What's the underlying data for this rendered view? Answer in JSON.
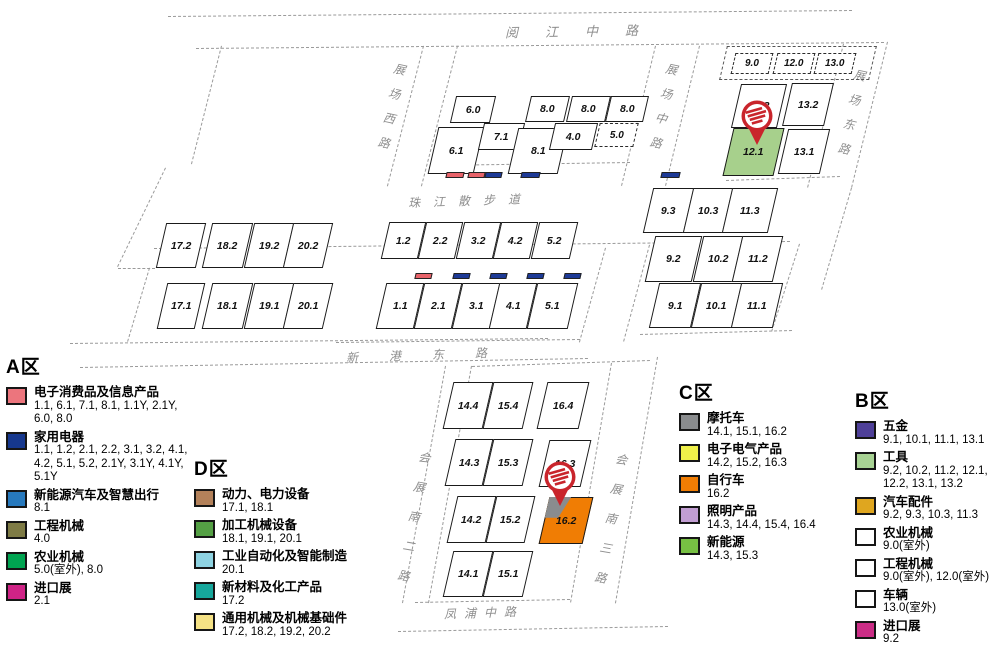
{
  "map": {
    "background": "#ffffff",
    "pin_color": "#c9252c",
    "roads_horizontal": [
      {
        "id": "yuejiang-middle-road",
        "label": "阅江中路",
        "x": 505,
        "y": 21,
        "fs": 13,
        "ls": 27,
        "rot": -1
      },
      {
        "id": "zhujiang-walkway",
        "label": "珠江散步道",
        "x": 408,
        "y": 192,
        "fs": 12,
        "ls": 13,
        "rot": -2
      },
      {
        "id": "xingang-east-road",
        "label": "新港东路",
        "x": 346,
        "y": 346,
        "fs": 12,
        "ls": 31,
        "rot": -2
      },
      {
        "id": "fengpu-middle-road",
        "label": "凤浦中路",
        "x": 444,
        "y": 604,
        "fs": 12,
        "ls": 8,
        "rot": -2
      }
    ],
    "roads_vertical": [
      {
        "id": "zhanchang-west-road",
        "label": "展场西路",
        "x": 396,
        "y": 58,
        "fs": 12,
        "pitch": 25,
        "rot": 12
      },
      {
        "id": "zhanchang-middle-road",
        "label": "展场中路",
        "x": 668,
        "y": 58,
        "fs": 12,
        "pitch": 25,
        "rot": 12
      },
      {
        "id": "zhanchang-east-road",
        "label": "展场东路",
        "x": 856,
        "y": 64,
        "fs": 12,
        "pitch": 25,
        "rot": 12
      },
      {
        "id": "huizhan-south-2nd-road",
        "label": "会展南二路",
        "x": 421,
        "y": 443,
        "fs": 12,
        "pitch": 30,
        "rot": 10
      },
      {
        "id": "huizhan-south-3rd-road",
        "label": "会展南三路",
        "x": 618,
        "y": 445,
        "fs": 12,
        "pitch": 30,
        "rot": 10
      }
    ],
    "boundary_lines": [
      [
        168,
        16,
        852,
        10
      ],
      [
        196,
        48,
        884,
        42
      ],
      [
        222,
        46,
        192,
        164
      ],
      [
        166,
        168,
        118,
        267
      ],
      [
        118,
        268,
        155,
        268
      ],
      [
        150,
        268,
        128,
        342
      ],
      [
        70,
        343,
        548,
        338
      ],
      [
        424,
        46,
        388,
        186
      ],
      [
        458,
        46,
        422,
        186
      ],
      [
        656,
        46,
        622,
        186
      ],
      [
        700,
        46,
        666,
        186
      ],
      [
        844,
        44,
        808,
        188
      ],
      [
        888,
        42,
        852,
        188
      ],
      [
        436,
        165,
        630,
        162
      ],
      [
        726,
        180,
        840,
        176
      ],
      [
        154,
        248,
        790,
        241
      ],
      [
        606,
        248,
        580,
        342
      ],
      [
        650,
        245,
        624,
        342
      ],
      [
        640,
        334,
        792,
        330
      ],
      [
        800,
        244,
        772,
        332
      ],
      [
        852,
        188,
        822,
        290
      ],
      [
        336,
        342,
        580,
        339
      ],
      [
        80,
        367,
        588,
        358
      ],
      [
        446,
        366,
        403,
        603
      ],
      [
        472,
        366,
        429,
        603
      ],
      [
        612,
        363,
        571,
        603
      ],
      [
        658,
        357,
        616,
        603
      ],
      [
        472,
        366,
        650,
        360
      ],
      [
        415,
        602,
        570,
        599
      ],
      [
        398,
        631,
        668,
        626
      ]
    ],
    "outdoor_group_outline": {
      "x": 723,
      "y": 46,
      "w": 150,
      "h": 34
    },
    "halls": [
      {
        "label": "6.0",
        "x": 453,
        "y": 96,
        "w": 40,
        "h": 27
      },
      {
        "label": "8.0",
        "x": 528,
        "y": 96,
        "w": 39,
        "h": 26
      },
      {
        "label": "8.0",
        "x": 569,
        "y": 96,
        "w": 39,
        "h": 26
      },
      {
        "label": "8.0",
        "x": 608,
        "y": 96,
        "w": 38,
        "h": 26
      },
      {
        "label": "6.1",
        "x": 433,
        "y": 127,
        "w": 46,
        "h": 47
      },
      {
        "label": "7.1",
        "x": 481,
        "y": 123,
        "w": 41,
        "h": 27
      },
      {
        "label": "8.1",
        "x": 513,
        "y": 128,
        "w": 50,
        "h": 46
      },
      {
        "label": "4.0",
        "x": 552,
        "y": 123,
        "w": 43,
        "h": 27
      },
      {
        "label": "5.0",
        "x": 597,
        "y": 123,
        "w": 39,
        "h": 24,
        "dashed": true
      },
      {
        "label": "9.0",
        "x": 733,
        "y": 53,
        "w": 38,
        "h": 21,
        "dashed": true
      },
      {
        "label": "12.0",
        "x": 775,
        "y": 53,
        "w": 38,
        "h": 21,
        "dashed": true
      },
      {
        "label": "13.0",
        "x": 816,
        "y": 53,
        "w": 38,
        "h": 21,
        "dashed": true
      },
      {
        "label": "12.2",
        "x": 736,
        "y": 84,
        "w": 46,
        "h": 44
      },
      {
        "label": "13.2",
        "x": 787,
        "y": 83,
        "w": 42,
        "h": 43
      },
      {
        "label": "12.1",
        "x": 728,
        "y": 128,
        "w": 51,
        "h": 48,
        "fill": "#a7d08c"
      },
      {
        "label": "13.1",
        "x": 783,
        "y": 129,
        "w": 42,
        "h": 45
      },
      {
        "label": "17.2",
        "x": 161,
        "y": 223,
        "w": 40,
        "h": 45
      },
      {
        "label": "18.2",
        "x": 207,
        "y": 223,
        "w": 41,
        "h": 45
      },
      {
        "label": "19.2",
        "x": 249,
        "y": 223,
        "w": 40,
        "h": 45
      },
      {
        "label": "20.2",
        "x": 288,
        "y": 223,
        "w": 40,
        "h": 45
      },
      {
        "label": "17.1",
        "x": 162,
        "y": 283,
        "w": 38,
        "h": 46
      },
      {
        "label": "18.1",
        "x": 207,
        "y": 283,
        "w": 41,
        "h": 46
      },
      {
        "label": "19.1",
        "x": 249,
        "y": 283,
        "w": 40,
        "h": 46
      },
      {
        "label": "20.1",
        "x": 288,
        "y": 283,
        "w": 40,
        "h": 46
      },
      {
        "label": "1.2",
        "x": 385,
        "y": 222,
        "w": 37,
        "h": 37
      },
      {
        "label": "2.2",
        "x": 422,
        "y": 222,
        "w": 37,
        "h": 37
      },
      {
        "label": "3.2",
        "x": 460,
        "y": 222,
        "w": 37,
        "h": 37
      },
      {
        "label": "4.2",
        "x": 497,
        "y": 222,
        "w": 37,
        "h": 37
      },
      {
        "label": "5.2",
        "x": 535,
        "y": 222,
        "w": 39,
        "h": 37
      },
      {
        "label": "1.1",
        "x": 381,
        "y": 283,
        "w": 38,
        "h": 46
      },
      {
        "label": "2.1",
        "x": 419,
        "y": 283,
        "w": 38,
        "h": 46
      },
      {
        "label": "3.1",
        "x": 457,
        "y": 283,
        "w": 38,
        "h": 46
      },
      {
        "label": "4.1",
        "x": 494,
        "y": 283,
        "w": 38,
        "h": 46
      },
      {
        "label": "5.1",
        "x": 532,
        "y": 283,
        "w": 41,
        "h": 46
      },
      {
        "label": "9.3",
        "x": 648,
        "y": 188,
        "w": 41,
        "h": 45
      },
      {
        "label": "10.3",
        "x": 688,
        "y": 188,
        "w": 40,
        "h": 45
      },
      {
        "label": "11.3",
        "x": 727,
        "y": 188,
        "w": 46,
        "h": 45
      },
      {
        "label": "9.2",
        "x": 650,
        "y": 236,
        "w": 47,
        "h": 46
      },
      {
        "label": "10.2",
        "x": 698,
        "y": 236,
        "w": 40,
        "h": 46
      },
      {
        "label": "11.2",
        "x": 737,
        "y": 236,
        "w": 41,
        "h": 46
      },
      {
        "label": "9.1",
        "x": 654,
        "y": 283,
        "w": 42,
        "h": 45
      },
      {
        "label": "10.1",
        "x": 696,
        "y": 283,
        "w": 41,
        "h": 45
      },
      {
        "label": "11.1",
        "x": 736,
        "y": 283,
        "w": 42,
        "h": 45
      },
      {
        "label": "14.4",
        "x": 448,
        "y": 382,
        "w": 40,
        "h": 47
      },
      {
        "label": "15.4",
        "x": 488,
        "y": 382,
        "w": 40,
        "h": 47
      },
      {
        "label": "16.4",
        "x": 542,
        "y": 382,
        "w": 42,
        "h": 47
      },
      {
        "label": "14.3",
        "x": 450,
        "y": 439,
        "w": 38,
        "h": 47
      },
      {
        "label": "15.3",
        "x": 488,
        "y": 439,
        "w": 40,
        "h": 47
      },
      {
        "label": "16.3",
        "x": 544,
        "y": 440,
        "w": 42,
        "h": 47
      },
      {
        "label": "14.2",
        "x": 452,
        "y": 496,
        "w": 39,
        "h": 47
      },
      {
        "label": "15.2",
        "x": 491,
        "y": 496,
        "w": 39,
        "h": 47
      },
      {
        "label": "16.2",
        "x": 544,
        "y": 497,
        "w": 44,
        "h": 47,
        "fill": "#f07d04",
        "corner": "#8a8c8e"
      },
      {
        "label": "14.1",
        "x": 448,
        "y": 551,
        "w": 40,
        "h": 46
      },
      {
        "label": "15.1",
        "x": 488,
        "y": 551,
        "w": 40,
        "h": 46
      }
    ],
    "annex_markers": [
      {
        "x": 446,
        "y": 172,
        "w": 18,
        "h": 6,
        "color": "#e8636a"
      },
      {
        "x": 468,
        "y": 172,
        "w": 17,
        "h": 6,
        "color": "#e8636a"
      },
      {
        "x": 485,
        "y": 172,
        "w": 17,
        "h": 6,
        "color": "#1d3a96"
      },
      {
        "x": 521,
        "y": 172,
        "w": 19,
        "h": 6,
        "color": "#1d3a96"
      },
      {
        "x": 661,
        "y": 172,
        "w": 19,
        "h": 6,
        "color": "#1d3a96"
      },
      {
        "x": 415,
        "y": 273,
        "w": 17,
        "h": 6,
        "color": "#e8636a"
      },
      {
        "x": 453,
        "y": 273,
        "w": 17,
        "h": 6,
        "color": "#1d3a96"
      },
      {
        "x": 490,
        "y": 273,
        "w": 17,
        "h": 6,
        "color": "#1d3a96"
      },
      {
        "x": 527,
        "y": 273,
        "w": 17,
        "h": 6,
        "color": "#1d3a96"
      },
      {
        "x": 564,
        "y": 273,
        "w": 17,
        "h": 6,
        "color": "#1d3a96"
      }
    ],
    "pins": [
      {
        "x": 737,
        "y": 99
      },
      {
        "x": 540,
        "y": 460
      }
    ]
  },
  "legends": {
    "a": {
      "title": "A区",
      "items": [
        {
          "name": "电子消费品及信息产品",
          "halls": "1.1, 6.1, 7.1, 8.1, 1.1Y, 2.1Y, 6.0, 8.0",
          "color": "#ec757d"
        },
        {
          "name": "家用电器",
          "halls": "1.1, 1.2, 2.1, 2.2, 3.1, 3.2, 4.1, 4.2, 5.1, 5.2, 2.1Y, 3.1Y, 4.1Y, 5.1Y",
          "color": "#16388e"
        },
        {
          "name": "新能源汽车及智慧出行",
          "halls": "8.1",
          "color": "#2779bd"
        },
        {
          "name": "工程机械",
          "halls": "4.0",
          "color": "#7e7b45"
        },
        {
          "name": "农业机械",
          "halls": "5.0(室外), 8.0",
          "color": "#00a451"
        },
        {
          "name": "进口展",
          "halls": "2.1",
          "color": "#cf2386"
        }
      ]
    },
    "d": {
      "title": "D区",
      "items": [
        {
          "name": "动力、电力设备",
          "halls": "17.1, 18.1",
          "color": "#b3815a"
        },
        {
          "name": "加工机械设备",
          "halls": "18.1, 19.1, 20.1",
          "color": "#54a044"
        },
        {
          "name": "工业自动化及智能制造",
          "halls": "20.1",
          "color": "#8ed3e2"
        },
        {
          "name": "新材料及化工产品",
          "halls": "17.2",
          "color": "#16a79c"
        },
        {
          "name": "通用机械及机械基础件",
          "halls": "17.2, 18.2, 19.2, 20.2",
          "color": "#f5e285"
        }
      ]
    },
    "c": {
      "title": "C区",
      "items": [
        {
          "name": "摩托车",
          "halls": "14.1, 15.1, 16.2",
          "color": "#8a8c8e"
        },
        {
          "name": "电子电气产品",
          "halls": "14.2, 15.2, 16.3",
          "color": "#eff04a"
        },
        {
          "name": "自行车",
          "halls": "16.2",
          "color": "#f07d04"
        },
        {
          "name": "照明产品",
          "halls": "14.3, 14.4, 15.4, 16.4",
          "color": "#c29ed3"
        },
        {
          "name": "新能源",
          "halls": "14.3, 15.3",
          "color": "#77c043"
        }
      ]
    },
    "b": {
      "title": "B区",
      "items": [
        {
          "name": "五金",
          "halls": "9.1, 10.1, 11.1, 13.1",
          "color": "#4f4099"
        },
        {
          "name": "工具",
          "halls": "9.2, 10.2, 11.2, 12.1, 12.2, 13.1, 13.2",
          "color": "#a8d394"
        },
        {
          "name": "汽车配件",
          "halls": "9.2, 9.3, 10.3, 11.3",
          "color": "#dfa61f"
        },
        {
          "name": "农业机械",
          "halls": "9.0(室外)",
          "color": "#ffffff"
        },
        {
          "name": "工程机械",
          "halls": "9.0(室外), 12.0(室外)",
          "color": "#ffffff"
        },
        {
          "name": "车辆",
          "halls": "13.0(室外)",
          "color": "#ffffff"
        },
        {
          "name": "进口展",
          "halls": "9.2",
          "color": "#cb2d86"
        }
      ]
    }
  }
}
